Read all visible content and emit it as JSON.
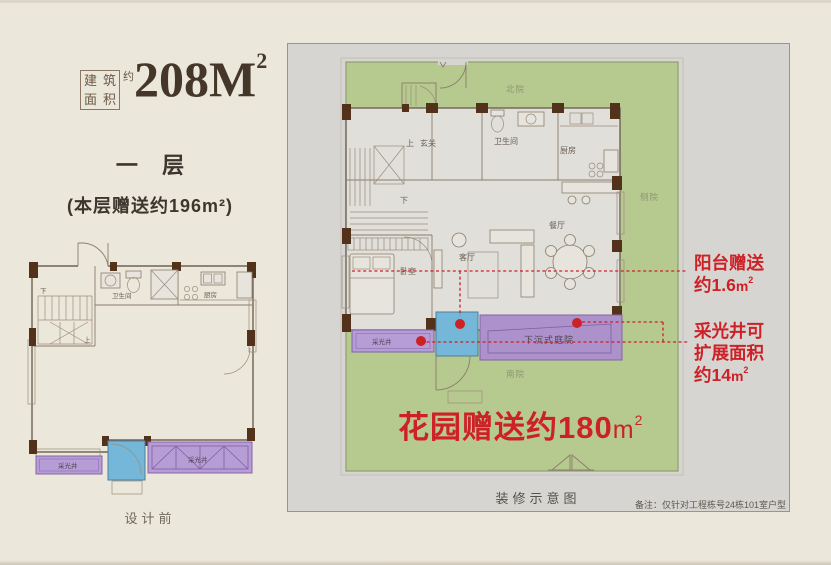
{
  "colors": {
    "paper": "#ece7db",
    "panel_bg": "#d6d5d1",
    "garden_green": "#b6c98f",
    "lightwell_purple": "#b79dd6",
    "courtyard_purple": "#ac91cb",
    "balcony_blue": "#74b7d8",
    "wall_brown": "#53321b",
    "accent_red": "#cd2127"
  },
  "header": {
    "area_prefix_chars": [
      "建",
      "筑",
      "面",
      "积"
    ],
    "area_prefix_approx": "约",
    "area_value": "208M",
    "area_superscript": "2",
    "floor_title": "一层",
    "floor_bonus": "(本层赠送约196m²)"
  },
  "left_plan": {
    "caption": "设计前",
    "labels": {
      "bathroom": "卫生间",
      "kitchen": "厨房",
      "up": "上",
      "down": "下",
      "lightwell_left": "采光井",
      "lightwell_right": "采光井"
    }
  },
  "right_plan": {
    "caption": "装修示意图",
    "note": "备注：仅针对工程栋号24栋101室户型",
    "garden": {
      "north": "北院",
      "side": "侧院",
      "south": "南院"
    },
    "rooms": {
      "foyer": "玄关",
      "up": "上",
      "down": "下",
      "bathroom": "卫生间",
      "kitchen": "厨房",
      "dining": "餐厅",
      "living": "客厅",
      "bedroom": "卧室",
      "lightwell": "采光井",
      "sunken_courtyard": "下沉式庭院"
    },
    "annotations": {
      "balcony": {
        "line1": "阳台赠送",
        "line2": "约1.6",
        "unit": "m",
        "sup": "2"
      },
      "lightwell": {
        "line1": "采光井可",
        "line2": "扩展面积",
        "line3": "约14",
        "unit": "m",
        "sup": "2"
      },
      "garden_gift": {
        "text": "花园赠送约180",
        "unit": "m",
        "sup": "2"
      }
    }
  }
}
